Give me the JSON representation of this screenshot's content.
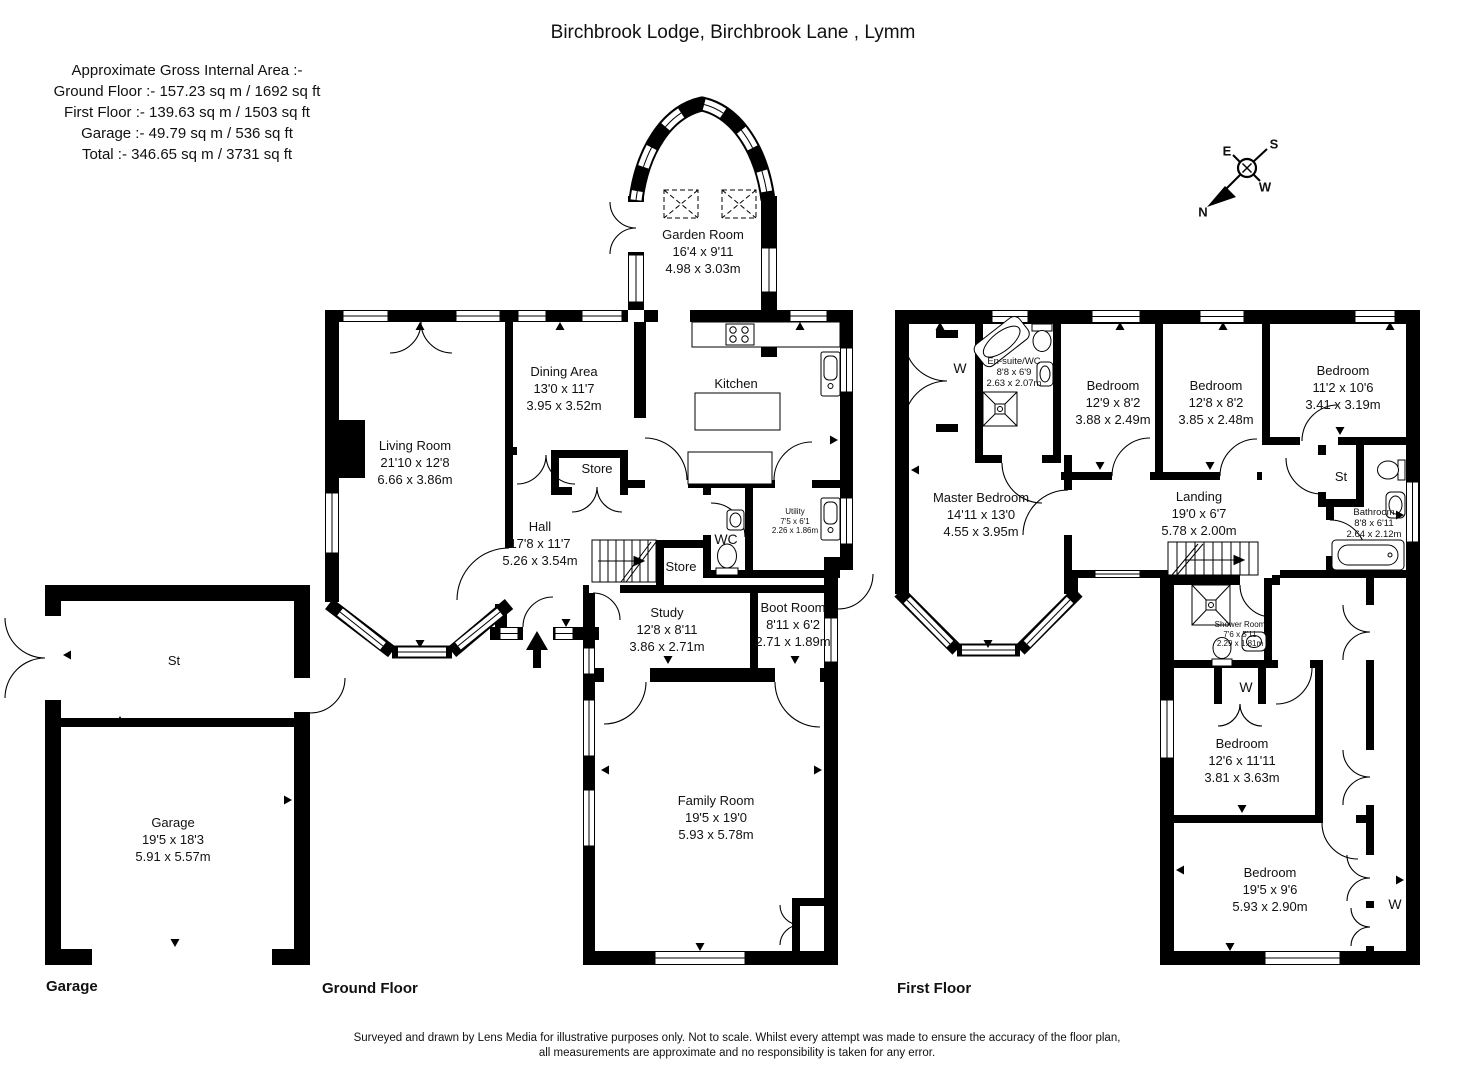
{
  "title": "Birchbrook Lodge, Birchbrook Lane , Lymm",
  "areas": {
    "heading": "Approximate Gross Internal Area :-",
    "lines": [
      "Ground Floor :- 157.23 sq m / 1692 sq ft",
      "First Floor :- 139.63 sq m / 1503 sq ft",
      "Garage :- 49.79 sq m / 536 sq ft",
      "Total :- 346.65 sq m / 3731 sq ft"
    ]
  },
  "floor_labels": {
    "garage": "Garage",
    "ground": "Ground Floor",
    "first": "First Floor"
  },
  "compass": {
    "n": "N",
    "e": "E",
    "s": "S",
    "w": "W"
  },
  "rooms": {
    "garden_room": {
      "name": "Garden Room",
      "imperial": "16'4 x 9'11",
      "metric": "4.98 x 3.03m"
    },
    "living_room": {
      "name": "Living Room",
      "imperial": "21'10 x 12'8",
      "metric": "6.66 x 3.86m"
    },
    "dining_area": {
      "name": "Dining Area",
      "imperial": "13'0 x 11'7",
      "metric": "3.95 x 3.52m"
    },
    "kitchen": {
      "name": "Kitchen"
    },
    "store_1": {
      "name": "Store"
    },
    "hall": {
      "name": "Hall",
      "imperial": "17'8 x 11'7",
      "metric": "5.26 x 3.54m"
    },
    "wc": {
      "name": "WC"
    },
    "utility": {
      "name": "Utility",
      "imperial": "7'5 x 6'1",
      "metric": "2.26 x 1.86m"
    },
    "store_2": {
      "name": "Store"
    },
    "study": {
      "name": "Study",
      "imperial": "12'8 x 8'11",
      "metric": "3.86 x 2.71m"
    },
    "boot_room": {
      "name": "Boot Room",
      "imperial": "8'11 x 6'2",
      "metric": "2.71 x 1.89m"
    },
    "family_room": {
      "name": "Family Room",
      "imperial": "19'5 x 19'0",
      "metric": "5.93 x 5.78m"
    },
    "garage_store": {
      "name": "St"
    },
    "garage": {
      "name": "Garage",
      "imperial": "19'5 x 18'3",
      "metric": "5.91 x 5.57m"
    },
    "master_bedroom": {
      "name": "Master Bedroom",
      "imperial": "14'11 x 13'0",
      "metric": "4.55 x 3.95m"
    },
    "ensuite": {
      "name": "En-suite/WC",
      "imperial": "8'8 x 6'9",
      "metric": "2.63 x 2.07m"
    },
    "wardrobe_master": {
      "name": "W"
    },
    "bedroom_1": {
      "name": "Bedroom",
      "imperial": "12'9 x 8'2",
      "metric": "3.88 x 2.49m"
    },
    "bedroom_2": {
      "name": "Bedroom",
      "imperial": "12'8 x 8'2",
      "metric": "3.85 x 2.48m"
    },
    "bedroom_3": {
      "name": "Bedroom",
      "imperial": "11'2 x 10'6",
      "metric": "3.41 x 3.19m"
    },
    "landing": {
      "name": "Landing",
      "imperial": "19'0 x 6'7",
      "metric": "5.78 x 2.00m"
    },
    "store_ff": {
      "name": "St"
    },
    "bathroom": {
      "name": "Bathroom",
      "imperial": "8'8 x 6'11",
      "metric": "2.64 x 2.12m"
    },
    "shower_room": {
      "name": "Shower Room",
      "imperial": "7'6 x 5'11",
      "metric": "2.29 x 1.81m"
    },
    "wardrobe_mid": {
      "name": "W"
    },
    "bedroom_4": {
      "name": "Bedroom",
      "imperial": "12'6 x 11'11",
      "metric": "3.81 x 3.63m"
    },
    "bedroom_5": {
      "name": "Bedroom",
      "imperial": "19'5 x 9'6",
      "metric": "5.93 x 2.90m"
    },
    "wardrobe_right": {
      "name": "W"
    }
  },
  "footer": {
    "line1": "Surveyed and drawn by Lens Media for illustrative purposes only. Not to scale. Whilst every attempt was made to ensure the accuracy of the floor plan,",
    "line2": "all measurements are approximate and no responsibility is taken for any error."
  }
}
